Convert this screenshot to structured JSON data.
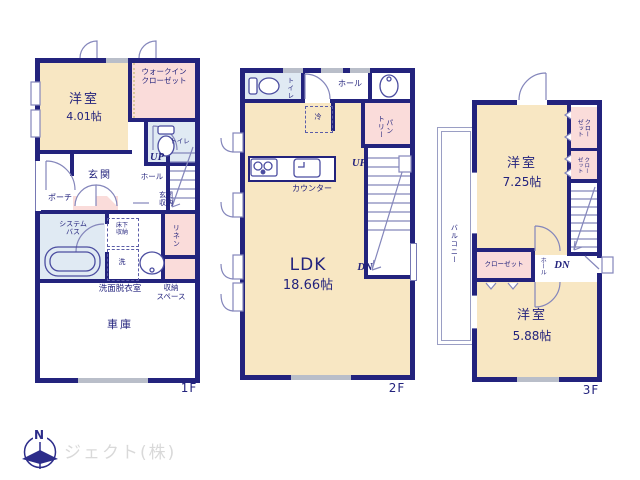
{
  "colors": {
    "wall": "#23237d",
    "room_beige": "#f8e7c3",
    "room_pink": "#fadcda",
    "room_blue": "#e0eaf3",
    "window_gray": "#b9bec9",
    "line": "#7678b4",
    "text": "#23237d",
    "logo_text": "#d9d9d9"
  },
  "floor1": {
    "floor_label": "1F",
    "yoshitsu_label": "洋室",
    "yoshitsu_size": "4.01帖",
    "wic_label": "ウォークイン\nクローゼット",
    "toilet_label": "トイレ",
    "genkan_label": "玄関",
    "porch_label": "ポーチ",
    "up_label": "UP",
    "hall_label": "ホール",
    "genkan_storage_label": "玄関\n収納",
    "bath_label": "システム\nバス",
    "underfloor_label": "床下\n収納",
    "washer_label": "洗",
    "linen_label": "リネン",
    "senmen_label": "洗面脱衣室",
    "storage_label": "収納\nスペース",
    "garage_label": "車庫"
  },
  "floor2": {
    "floor_label": "2F",
    "toilet_label": "トイレ",
    "hall_label": "ホール",
    "fridge_label": "冷",
    "pantry_label": "パン\nトリー",
    "counter_label": "カウンター",
    "up_label": "UP",
    "dn_label": "DN",
    "ldk_label": "LDK",
    "ldk_size": "18.66帖"
  },
  "floor3": {
    "floor_label": "3F",
    "room1_label": "洋室",
    "room1_size": "7.25帖",
    "closet1_label": "クロー\nゼット",
    "closet2_label": "クロー\nゼット",
    "closet3_label": "クローゼット",
    "hall_label": "ホール",
    "dn_label": "DN",
    "room2_label": "洋室",
    "room2_size": "5.88帖",
    "balcony_label": "バルコニー"
  },
  "logo": {
    "north_label": "N",
    "company": "ジェクト(株)"
  }
}
